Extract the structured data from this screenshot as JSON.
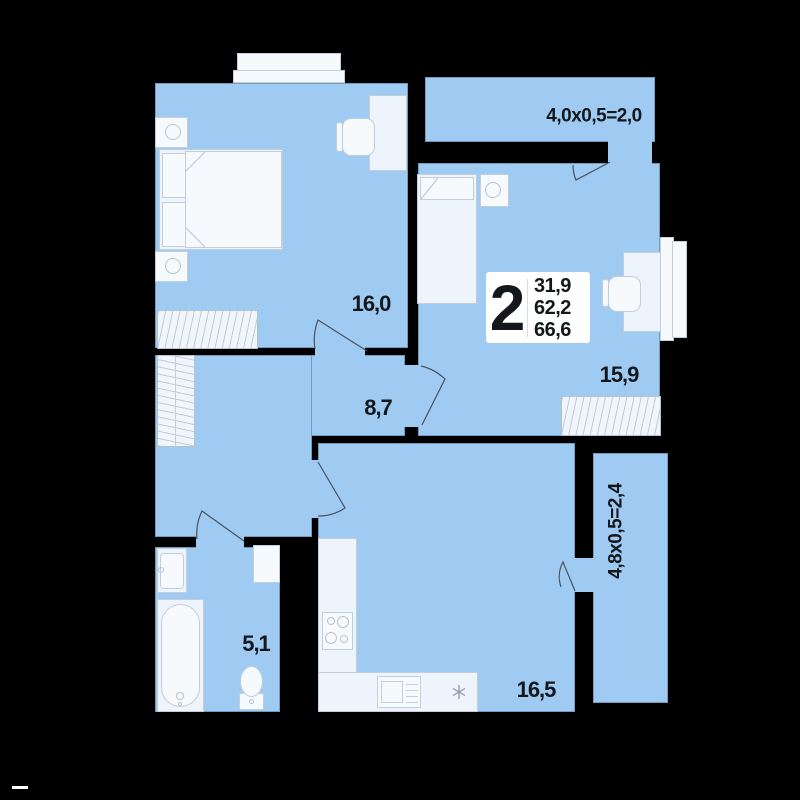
{
  "colors": {
    "background": "#000000",
    "room_fill": "#9fcbf2",
    "furniture_fill": "#eef4fb",
    "text": "#14181c"
  },
  "rooms": [
    {
      "name": "bedroom-1",
      "label": "16,0"
    },
    {
      "name": "bedroom-2",
      "label": "15,9"
    },
    {
      "name": "hallway",
      "label": "8,7"
    },
    {
      "name": "bathroom",
      "label": "5,1"
    },
    {
      "name": "kitchen-living",
      "label": "16,5"
    },
    {
      "name": "balcony-top",
      "label": "4,0x0,5=2,0"
    },
    {
      "name": "balcony-side",
      "label": "4,8x0,5=2,4"
    }
  ],
  "info_box": {
    "rooms_count": "2",
    "area_living": "31,9",
    "area_total": "62,2",
    "area_full": "66,6"
  }
}
